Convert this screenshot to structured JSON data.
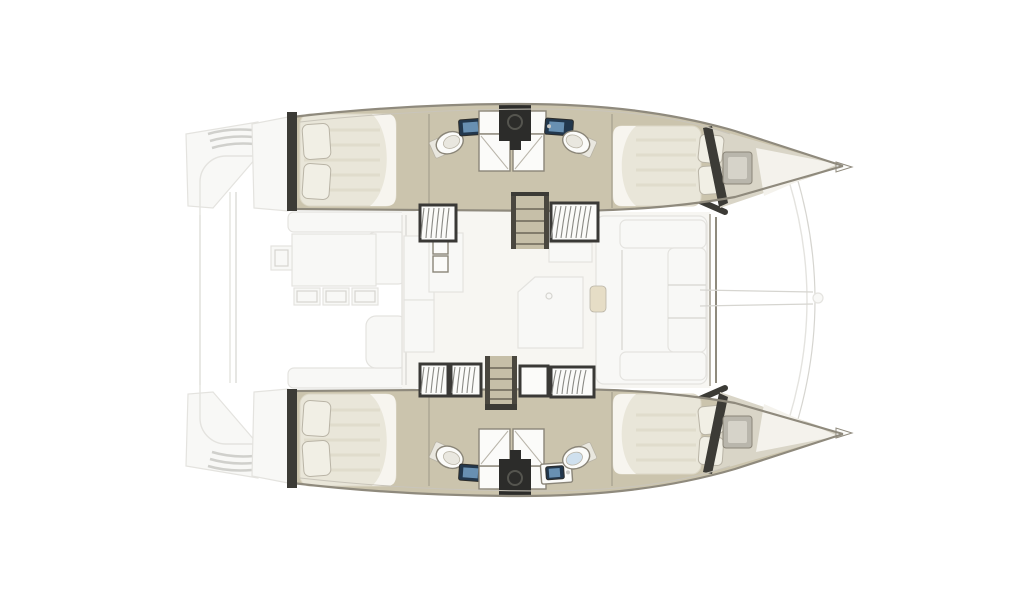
{
  "diagram": {
    "type": "catamaran-floor-plan",
    "orientation": "bow-right",
    "canvas": {
      "width": 1024,
      "height": 600
    },
    "colors": {
      "bg": "#ffffff",
      "hull_edge": "#8f8a7d",
      "hull_edge_light": "#c9c5ba",
      "wall_dark": "#3c3b36",
      "wood_floor": "#cbc4ad",
      "wood_stair": "#c6bfa8",
      "rail_dark": "#4a473f",
      "tread": "#6b6658",
      "bow_deck": "#d9d5c7",
      "bow_sheen": "#f4f2ec",
      "bed": "#e9e6d9",
      "bed_stripe": "#dcd7c6",
      "bed_white": "#f7f5ef",
      "pillow": "#f1efe5",
      "pillow_edge": "#b9b4a6",
      "fixture_white": "#fbfbf9",
      "fixture_inner": "#e9e7df",
      "fixture_edge": "#8a8578",
      "shower_line": "#b9b5aa",
      "sink_navy": "#22374c",
      "sink_glass": "#74a0c4",
      "metal": "#c9c9c6",
      "equipment_dark": "#2c2c2a",
      "equipment_mid": "#55554f",
      "louver_frame": "#3a3936",
      "louver_slat": "#8a8a85",
      "hatch_gray": "#b9b6ac",
      "hatch_gray_light": "#d6d3c9",
      "faint_line": "#e4e3df",
      "faint_line2": "#d6d5d0",
      "faint_fill": "#f8f8f6",
      "salon_floor": "#f7f6f2",
      "cushion_tan": "#e6ddc6",
      "step_gray": "#d0d0cc",
      "toilet_blue": "#cfe0ee"
    },
    "regions": [
      "stern-swim-platform-port",
      "stern-swim-platform-starboard",
      "aft-cockpit",
      "cockpit-table-and-chairs",
      "salon",
      "galley",
      "salon-lounge",
      "port-hull",
      "starboard-hull",
      "aft-cabin-port",
      "forward-cabin-port",
      "aft-cabin-starboard",
      "forward-cabin-starboard",
      "bathroom-aft-port",
      "bathroom-forward-port",
      "bathroom-aft-starboard",
      "bathroom-forward-starboard",
      "shower-stalls-port",
      "shower-stalls-starboard",
      "companionway-stairs-port",
      "companionway-stairs-starboard",
      "bow-deck-port",
      "bow-deck-starboard",
      "bowsprit",
      "forward-crossbeam"
    ]
  }
}
